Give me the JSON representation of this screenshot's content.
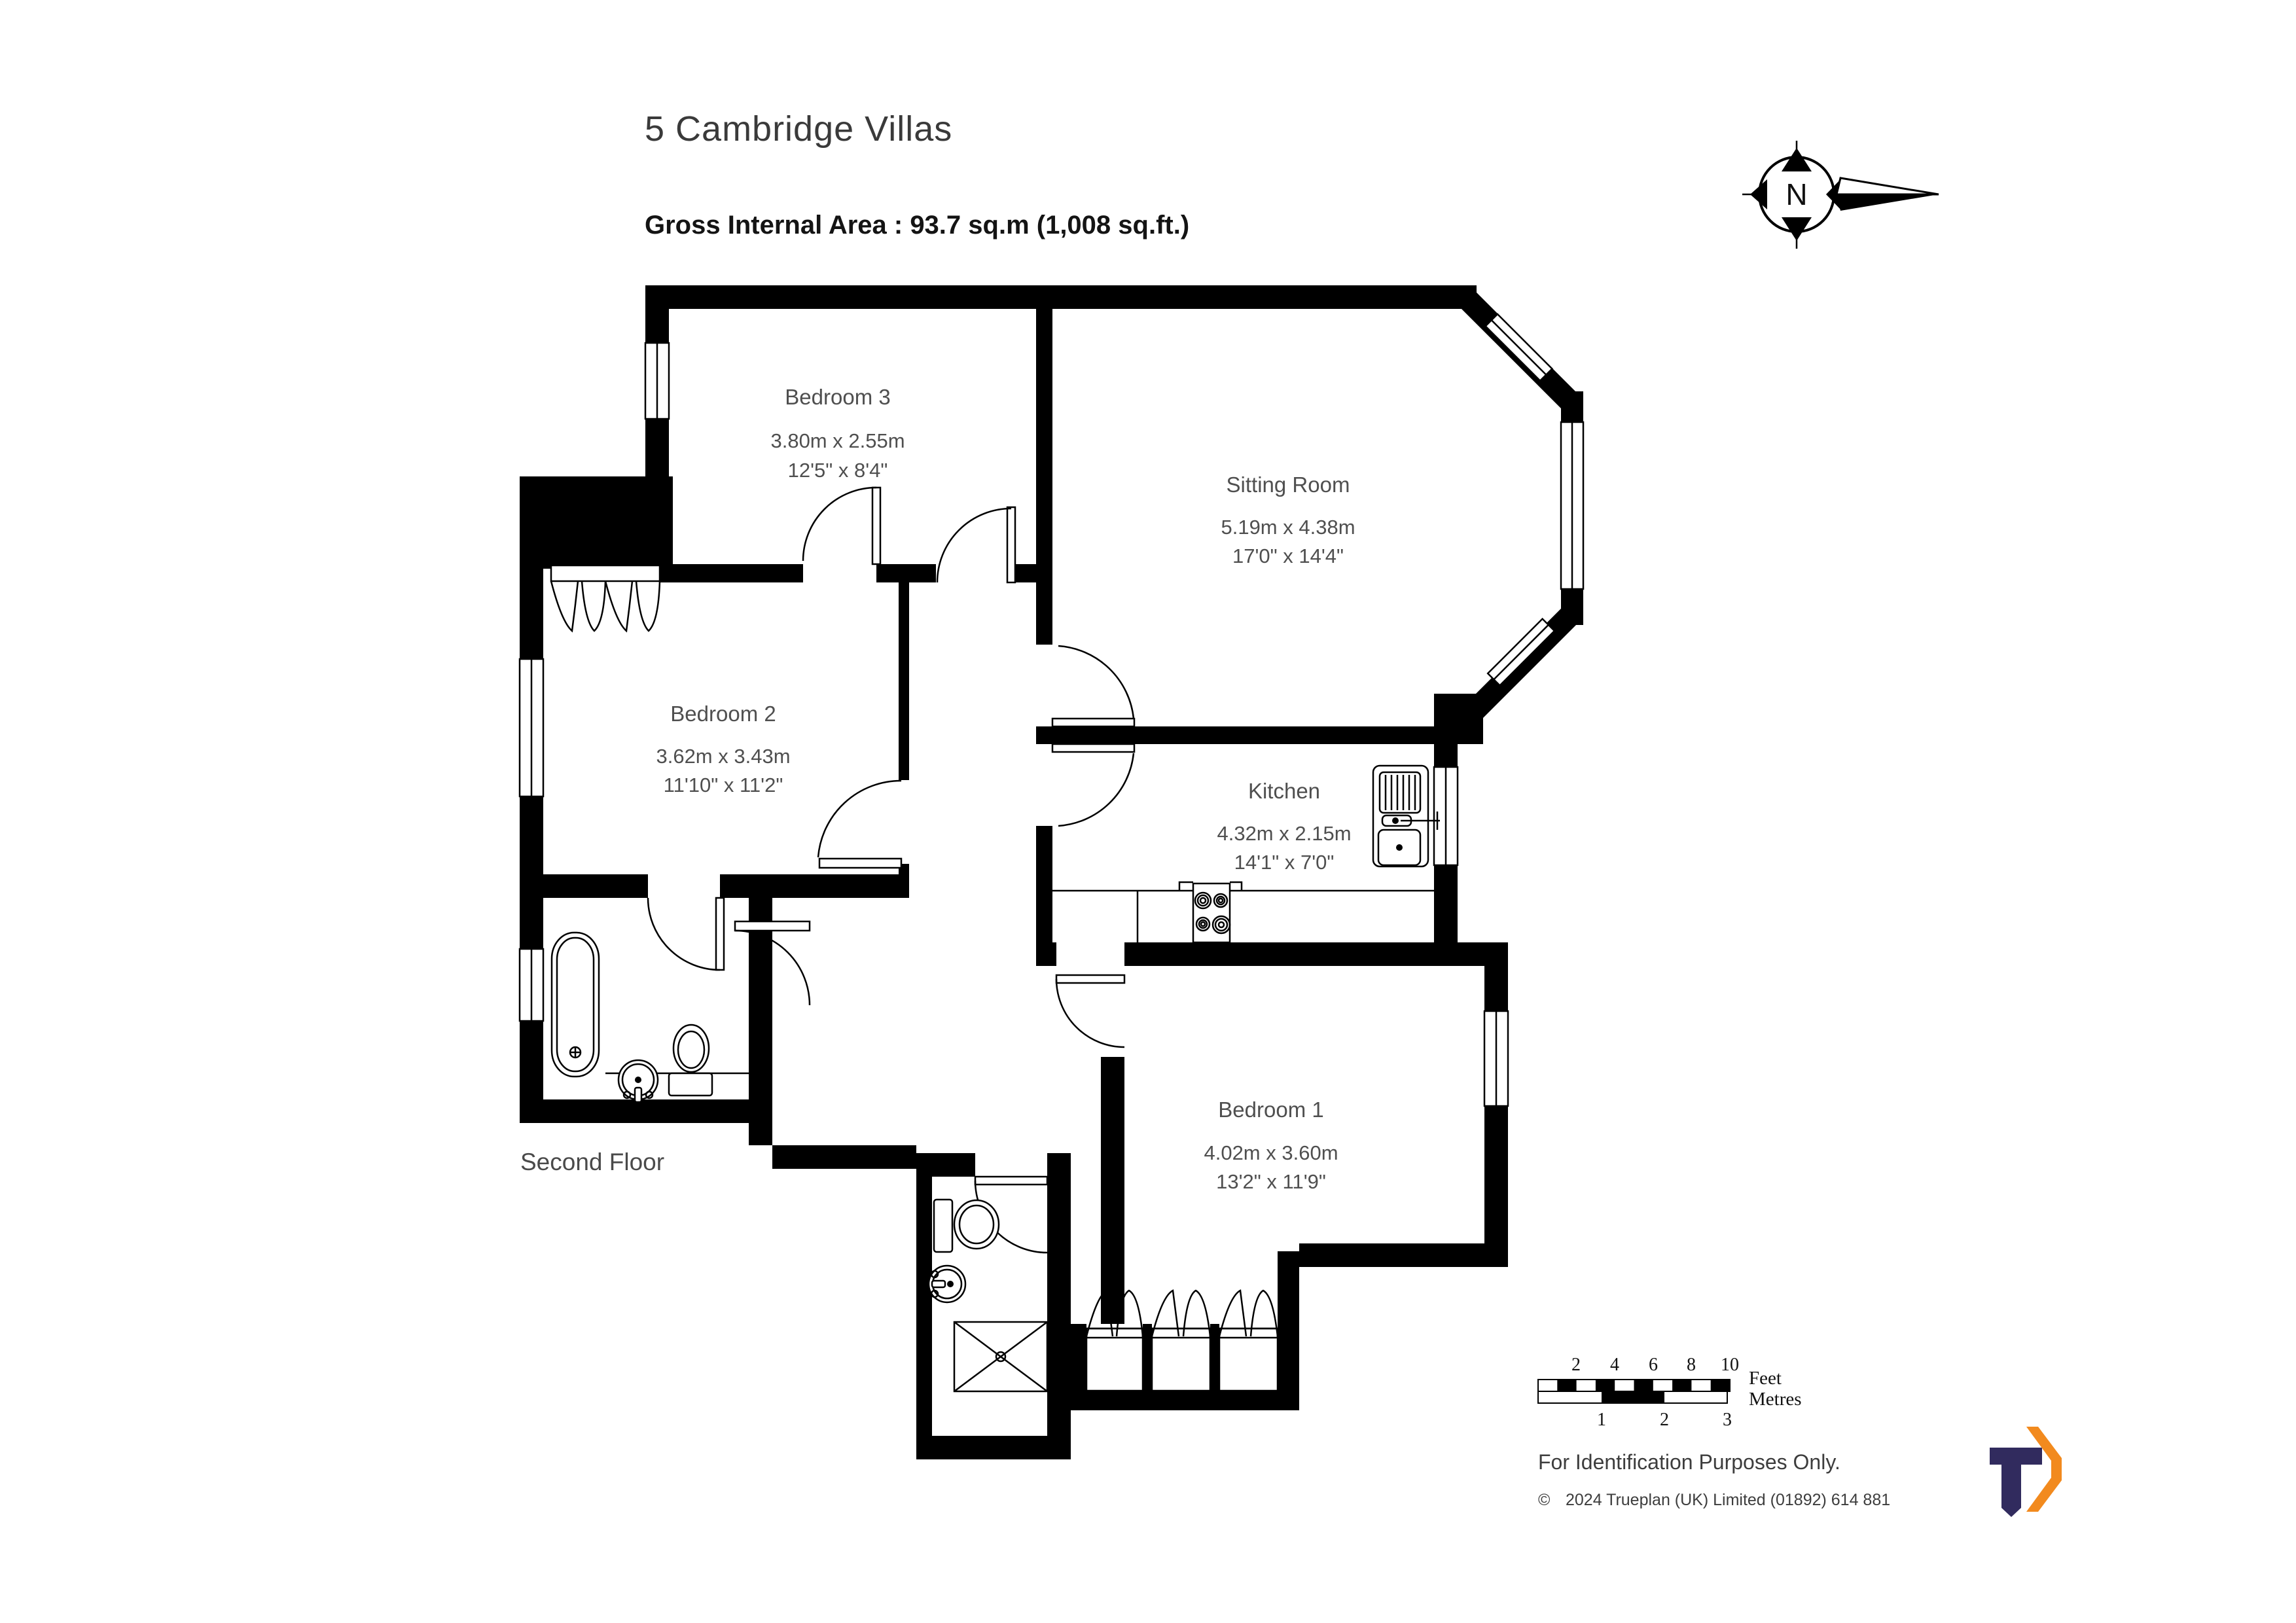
{
  "title": "5 Cambridge Villas",
  "area_line": "Gross Internal Area  :  93.7 sq.m   (1,008 sq.ft.)",
  "floor_label": "Second Floor",
  "compass": {
    "letter": "N"
  },
  "rooms": [
    {
      "name": "Bedroom 3",
      "metric": "3.80m  x  2.55m",
      "imperial": "12'5\"  x  8'4\""
    },
    {
      "name": "Sitting Room",
      "metric": "5.19m  x  4.38m",
      "imperial": "17'0\"  x  14'4\""
    },
    {
      "name": "Bedroom 2",
      "metric": "3.62m  x  3.43m",
      "imperial": "11'10\"  x  11'2\""
    },
    {
      "name": "Kitchen",
      "metric": "4.32m  x  2.15m",
      "imperial": "14'1\"  x  7'0\""
    },
    {
      "name": "Bedroom 1",
      "metric": "4.02m  x  3.60m",
      "imperial": "13'2\"  x  11'9\""
    }
  ],
  "scale_bar": {
    "feet_ticks": [
      "2",
      "4",
      "6",
      "8",
      "10"
    ],
    "metre_ticks": [
      "1",
      "2",
      "3"
    ],
    "feet_label": "Feet",
    "metres_label": "Metres"
  },
  "footer": {
    "purpose": "For  Identification  Purposes  Only.",
    "copyright_symbol": "©",
    "copyright": "2024 Trueplan (UK) Limited  (01892) 614 881"
  },
  "colors": {
    "navy": "#312b5e",
    "orange": "#f28a1e"
  }
}
